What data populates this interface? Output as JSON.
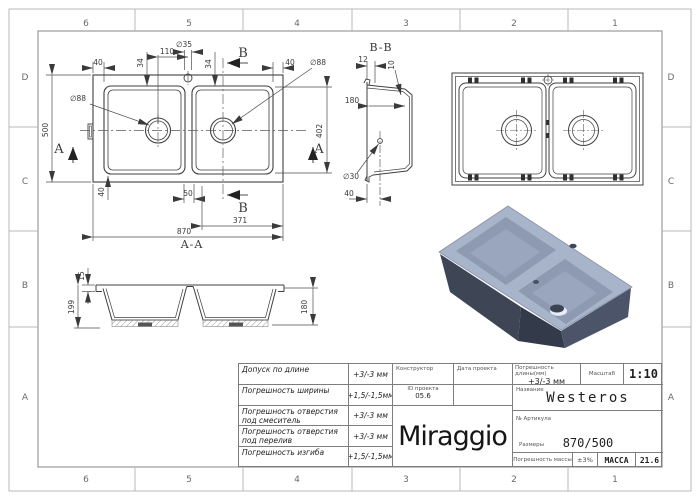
{
  "frame": {
    "top_labels": [
      "6",
      "5",
      "4",
      "3",
      "2",
      "1"
    ],
    "bottom_labels": [
      "6",
      "5",
      "4",
      "3",
      "2",
      "1"
    ],
    "left_labels": [
      "D",
      "C",
      "B",
      "A"
    ],
    "right_labels": [
      "D",
      "C",
      "B",
      "A"
    ]
  },
  "plan": {
    "d40_top_left": "40",
    "d34_left": "34",
    "d110": "110",
    "d35": "∅35",
    "d34_right": "34",
    "b_top": "B",
    "d40_top_right": "40",
    "d88_left": "∅88",
    "d88_right": "∅88",
    "d500": "500",
    "a_left": "A",
    "a_right": "A",
    "d402": "402",
    "d40_bottom_left": "40",
    "d50": "50",
    "b_bottom": "B",
    "d371": "371",
    "d870": "870",
    "section_label": "A-A"
  },
  "section_bb": {
    "title": "B-B",
    "d12": "12",
    "d10": "10",
    "d180": "180",
    "d30": "∅30",
    "d40": "40"
  },
  "section_aa": {
    "d15": "15",
    "d199": "199",
    "d180": "180"
  },
  "title_block": {
    "tolerances": [
      {
        "name": "Допуск по длине",
        "value": "+3/-3 мм"
      },
      {
        "name": "Погрешность ширины",
        "value": "+1,5/-1,5мм"
      },
      {
        "name": "Погрешность отверстия под смеситель",
        "value": "+3/-3 мм"
      },
      {
        "name": "Погрешность отверстия под перелив",
        "value": "+3/-3 мм"
      },
      {
        "name": "Погрешность изгиба",
        "value": "+1,5/-1,5мм"
      }
    ],
    "constructor_label": "Конструктор",
    "project_date_label": "Дата проекта",
    "project_id_label": "ID проекта",
    "project_id_value": "05.6",
    "logo": "Miraggio",
    "length_tolerance_label": "Погрешность длины(мм)",
    "length_tolerance_value": "+3/-3 мм",
    "scale_label": "Масштаб",
    "scale_value": "1:10",
    "name_label": "Название",
    "name_value": "Westeros",
    "article_label": "№ Артикула",
    "sizes_label": "Размеры",
    "sizes_value": "870/500",
    "mass_tolerance_label": "Погрешность массы",
    "mass_tolerance_value": "±3%",
    "mass_label": "МАССА",
    "mass_value": "21.6"
  },
  "colors": {
    "line": "#3f3f3f",
    "frame": "#9a9a9a",
    "render_rim": "#a8b4ca",
    "render_wall": "#8e9ab2",
    "render_side_dark": "#3e4656",
    "render_side_mid": "#4b5468"
  }
}
